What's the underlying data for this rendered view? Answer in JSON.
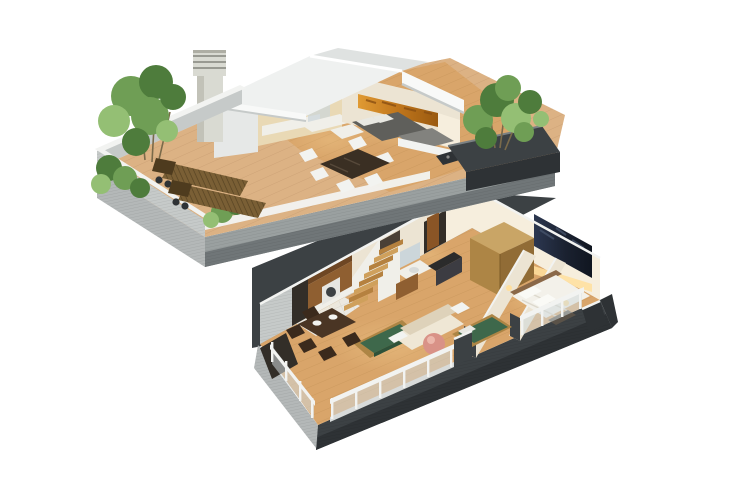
{
  "figure": {
    "alt": "3D isometric cutaway floor plan render of a two-storey penthouse apartment on a white background",
    "type": "architectural-3d-floorplan",
    "levels": [
      {
        "id": "upper-level",
        "label": "Upper level with roof terrace",
        "rooms": [
          {
            "name": "roof-terrace",
            "items": [
              "wood plank deck",
              "two wooden sun loungers",
              "green shrubs and bamboo plants",
              "concrete parapet walls",
              "corner planter",
              "barbecue"
            ]
          },
          {
            "name": "open-plan-interior",
            "items": [
              "kitchen counter",
              "glass shower partition",
              "dark dining table",
              "six white chairs",
              "gray double bed",
              "gray sofa",
              "orange panoramic wall art"
            ]
          },
          {
            "name": "roof",
            "items": [
              "white gable roof",
              "slatted chimney"
            ]
          }
        ]
      },
      {
        "id": "lower-level",
        "label": "Lower level apartment",
        "rooms": [
          {
            "name": "kitchen",
            "items": [
              "wood cabinets",
              "white appliance",
              "tiled floor"
            ]
          },
          {
            "name": "staircase",
            "items": [
              "wooden steps",
              "white stringer wall"
            ]
          },
          {
            "name": "bathroom",
            "items": [
              "white basin counter",
              "mirror",
              "wood vanity"
            ]
          },
          {
            "name": "hallway",
            "items": [
              "open wooden door",
              "dark media desk"
            ]
          },
          {
            "name": "living-room",
            "items": [
              "cream sofa",
              "green daybed",
              "pink sphere lamp",
              "dark wood dining table",
              "dark chairs",
              "white plates"
            ]
          },
          {
            "name": "second-bedroom",
            "items": [
              "green single bed",
              "partition wall"
            ]
          },
          {
            "name": "master-bedroom",
            "items": [
              "white double bed",
              "two pillows",
              "wood wardrobe",
              "navy panoramic wall art",
              "warm cove lighting"
            ]
          },
          {
            "name": "balconies",
            "items": [
              "white handrails",
              "glass balustrade panels",
              "concrete slab edges"
            ]
          }
        ]
      }
    ]
  },
  "palette": {
    "bg": "#ffffff",
    "concrete_light": "#c6cac9",
    "concrete_mid": "#9aa0a0",
    "concrete_dark": "#707678",
    "charcoal": "#3c4144",
    "charcoal_deep": "#2e3235",
    "slab_face_light": "#b4b8b8",
    "deck_wood": "#dcb284",
    "deck_line": "#c0946a",
    "floor_wood": "#d9a56a",
    "floor_line": "#bd8c50",
    "roof_white": "#eff1f0",
    "roof_fascia": "#f8f9f8",
    "roof_shadow": "#c6cac9",
    "roof_back": "#dfe2e1",
    "gable": "#e6e8e7",
    "chimney": "#d9dad2",
    "chimney_dark": "#84847c",
    "wall_cream": "#ece4d3",
    "wall_lit": "#f6eedd",
    "wall_warm": "#e9d9b5",
    "cabinet_wood": "#8f5f31",
    "cabinet_dark": "#6e4623",
    "counter_white": "#f0efe9",
    "art_orange": "#cd8326",
    "art_orange_dark": "#8a4f12",
    "art_navy": "#232b39",
    "art_navy_hi": "#4a5870",
    "glow": "#ffdf9e",
    "bed_gray": "#5f5f5b",
    "sofa_gray": "#82827e",
    "pillow": "#e8e8e2",
    "sofa_cream": "#efe7d5",
    "sofa_shade": "#ded2ba",
    "green_bed": "#3e684b",
    "green_dark": "#2e523a",
    "table_brown": "#4a3524",
    "chair_brown": "#3b2a1c",
    "chair_white": "#f2f3f0",
    "wood_door": "#8a5526",
    "wardrobe_top": "#c9a566",
    "wardrobe_l": "#ad8545",
    "wardrobe_r": "#916c36",
    "stair_wood": "#b5813f",
    "stair_wood_hi": "#cfa05c",
    "plant_green": "#6f9e55",
    "plant_dark": "#4e7c3c",
    "plant_light": "#94bf74",
    "lounger": "#7a5f35",
    "lounger_dark": "#4e3b1e",
    "glass": "#cfd8db",
    "rail_white": "#f2f3f1",
    "rail_base": "#d8dbda",
    "tile": "#ebe9e3",
    "tile_line": "#d5d2c9",
    "pink": "#d99287",
    "dark_opening": "#332e28",
    "appliance": "#e6e6e2",
    "mirror": "#ccd6da",
    "screen_dark": "#2b2b2b"
  }
}
